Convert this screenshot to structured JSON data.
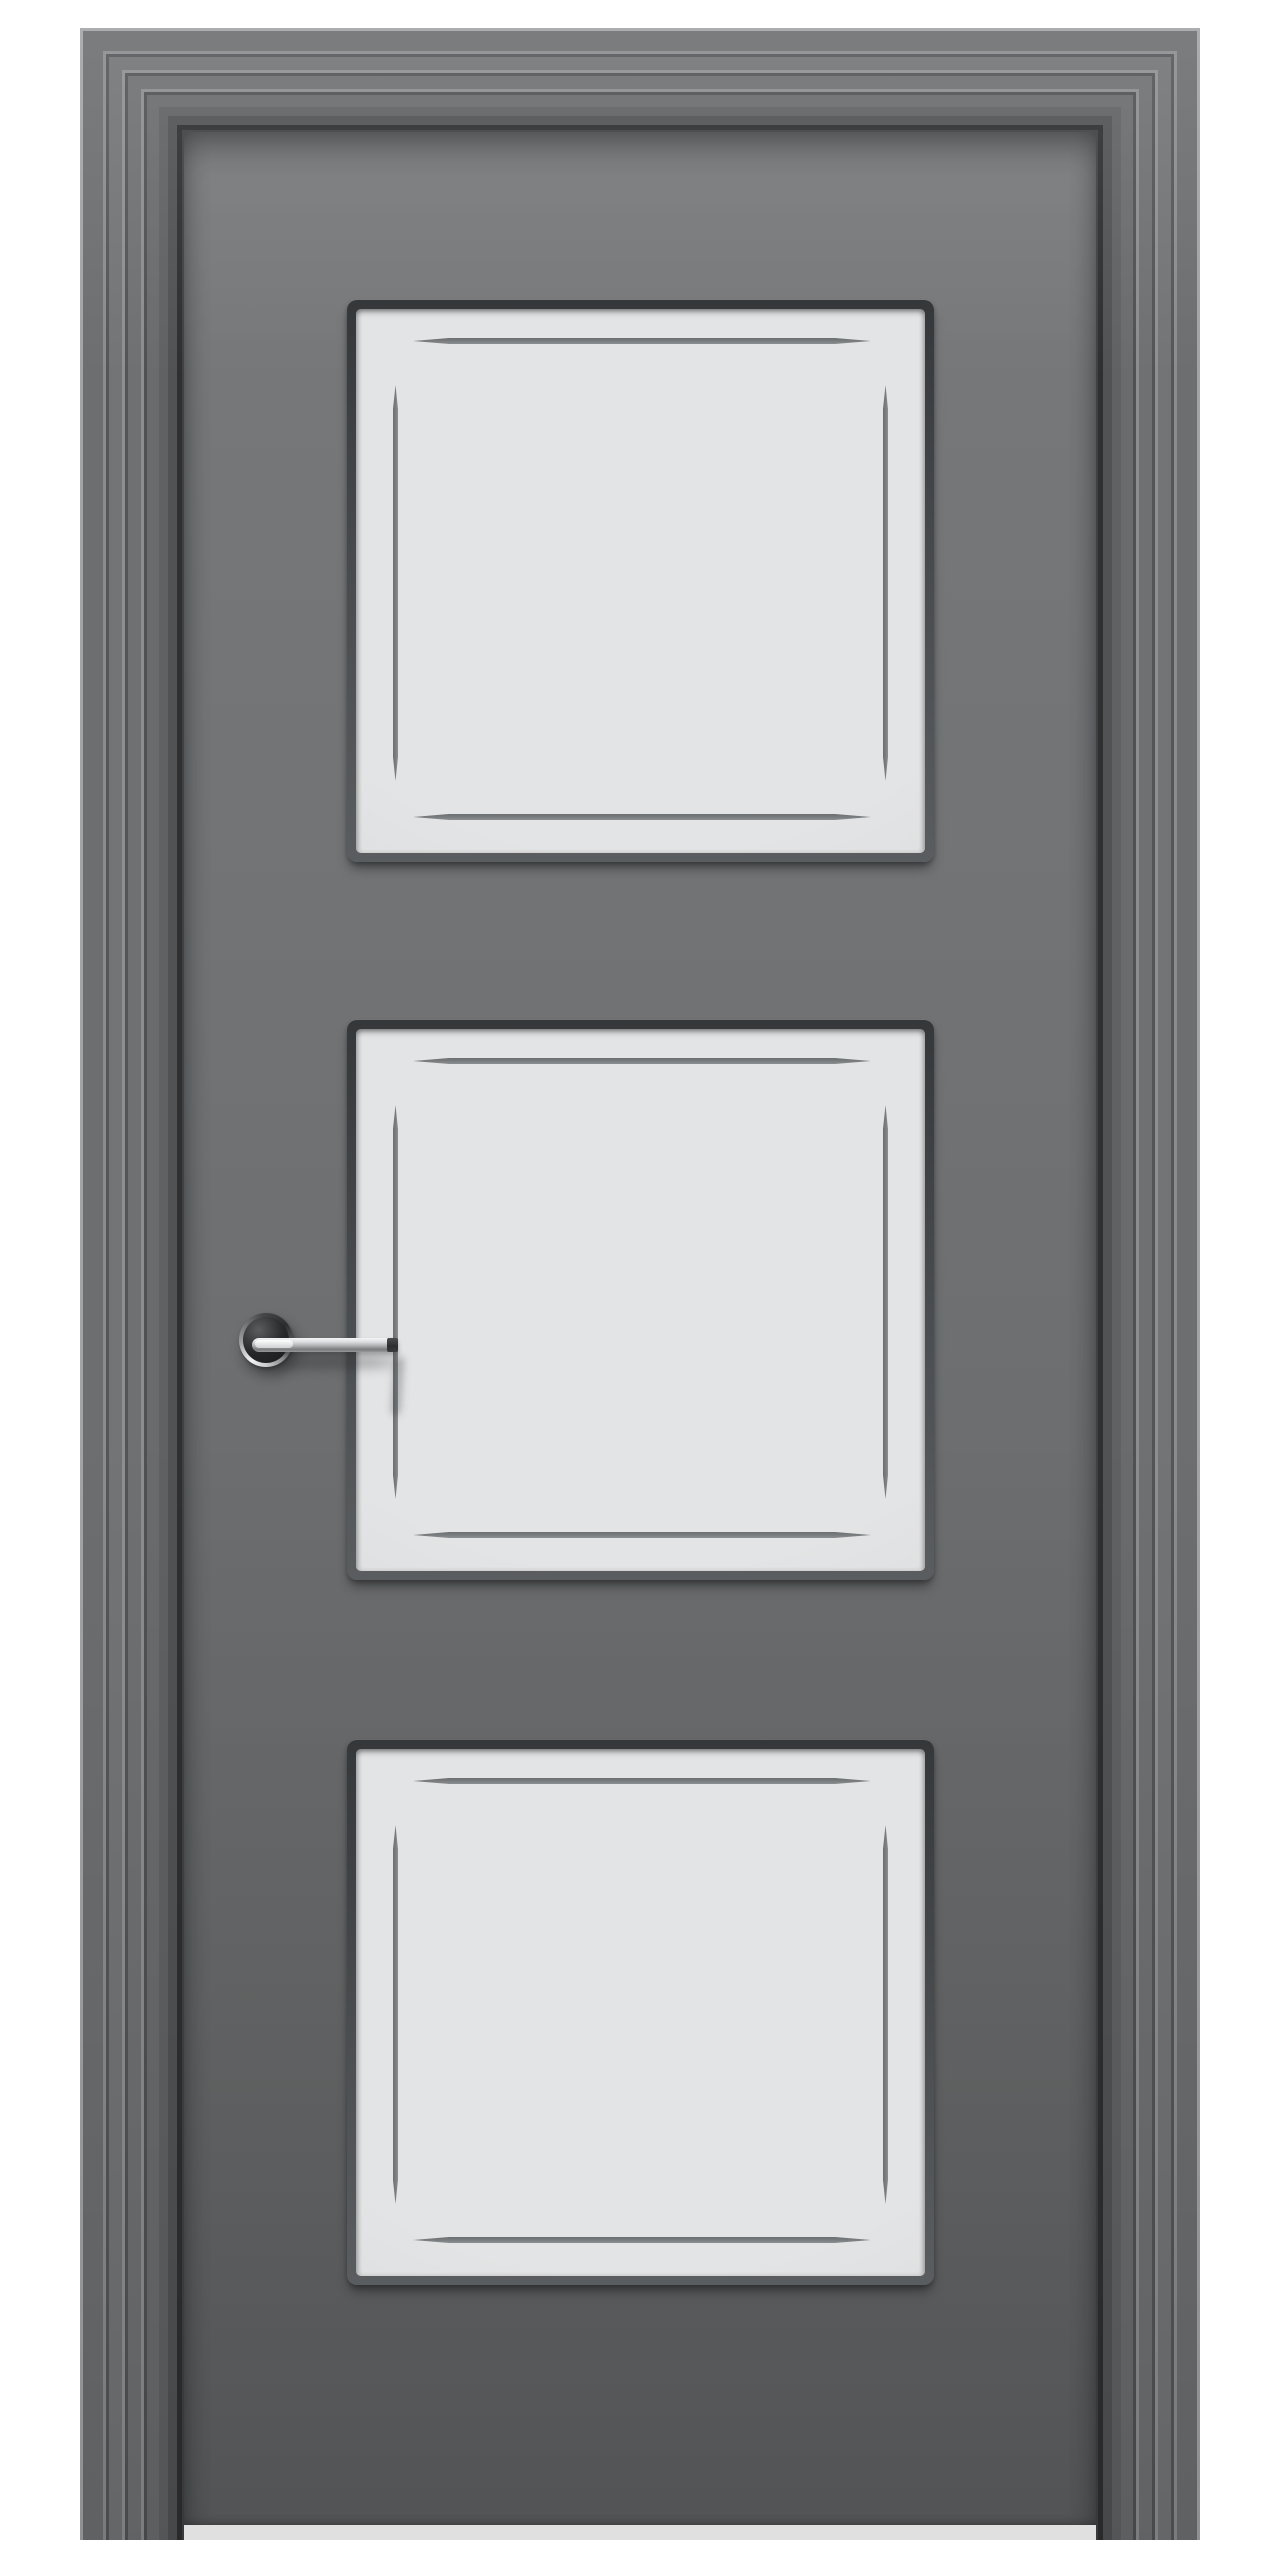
{
  "scene": {
    "subject": "interior door with three frosted glass panels",
    "view": "front",
    "panel_count": 3,
    "handle_finish": "polished-chrome",
    "handle_side": "left"
  },
  "colors": {
    "background": "#ffffff",
    "slab_top": "#77797b",
    "slab_mid": "#707274",
    "slab_mid2": "#666869",
    "slab_bottom": "#5d5f61",
    "glass": "#e3e4e5",
    "glass_edge": "#d7d8d9",
    "groove": "#7b7e80",
    "bead_dark": "#35383a",
    "bead_mid": "#4b4e51",
    "bead_light": "#5a5d60",
    "chrome_light": "#f4f5f6",
    "chrome_mid": "#aeb0b2",
    "rosette_face": "#26282a"
  },
  "door": {
    "canvas": {
      "width": 1280,
      "height": 2560
    },
    "casing": {
      "left": 80,
      "top": 28,
      "width": 1120,
      "height": 2512,
      "rings": [
        {
          "w": 3,
          "c": "#a2a4a6"
        },
        {
          "w": 20,
          "c": "#6c6e70"
        },
        {
          "w": 3,
          "c": "#8a8c8e"
        },
        {
          "w": 3,
          "c": "#54565a"
        },
        {
          "w": 13,
          "c": "#727476"
        },
        {
          "w": 3,
          "c": "#8d8f91"
        },
        {
          "w": 3,
          "c": "#525456"
        },
        {
          "w": 13,
          "c": "#6e7072"
        },
        {
          "w": 3,
          "c": "#8b8d8f"
        },
        {
          "w": 3,
          "c": "#4f5153"
        },
        {
          "w": 12,
          "c": "#696b6d"
        },
        {
          "w": 9,
          "c": "#5f6163"
        },
        {
          "w": 9,
          "c": "#505254"
        },
        {
          "w": 5,
          "c": "#2d2f31"
        },
        {
          "w": 2,
          "c": "#3f4143"
        }
      ]
    },
    "slab": {
      "left": 184,
      "top": 132,
      "width": 912,
      "height": 2393
    },
    "panels": {
      "x": 347,
      "width": 587,
      "items": [
        {
          "top": 300,
          "height": 562
        },
        {
          "top": 1020,
          "height": 560
        },
        {
          "top": 1740,
          "height": 545
        }
      ]
    },
    "handle": {
      "rosette": {
        "cx": 266,
        "cy": 1340,
        "r": 27
      },
      "lever": {
        "x": 252,
        "y": 1338,
        "width": 146,
        "height": 14
      },
      "shadow": {
        "x": 246,
        "y": 1356,
        "width": 152,
        "height": 12
      },
      "tip_shadow": {
        "x": 393,
        "y": 1357,
        "width": 9,
        "height": 58
      }
    }
  }
}
